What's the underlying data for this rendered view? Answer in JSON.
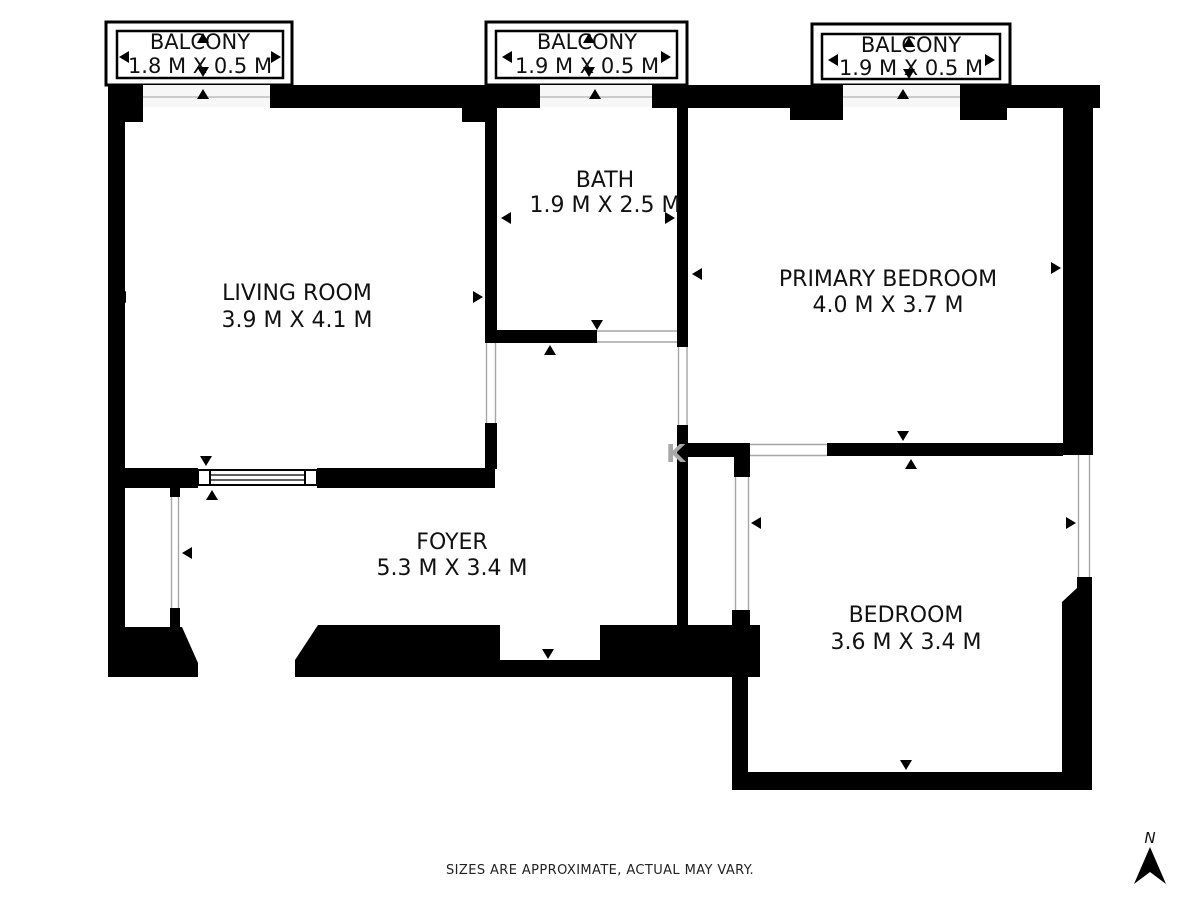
{
  "plan": {
    "balconies": [
      {
        "name": "BALCONY",
        "dims": "1.8 M X 0.5 M"
      },
      {
        "name": "BALCONY",
        "dims": "1.9 M X 0.5 M"
      },
      {
        "name": "BALCONY",
        "dims": "1.9 M X 0.5 M"
      }
    ],
    "rooms": [
      {
        "name": "LIVING ROOM",
        "dims": "3.9 M X 4.1 M"
      },
      {
        "name": "BATH",
        "dims": "1.9 M X 2.5 M"
      },
      {
        "name": "PRIMARY BEDROOM",
        "dims": "4.0 M X 3.7 M"
      },
      {
        "name": "FOYER",
        "dims": "5.3 M X 3.4 M"
      },
      {
        "name": "BEDROOM",
        "dims": "3.6 M X 3.4 M"
      }
    ],
    "disclaimer": "SIZES ARE APPROXIMATE, ACTUAL MAY VARY.",
    "compass": {
      "label": "N"
    },
    "watermark": "K",
    "colors": {
      "wall": "#000000",
      "background": "#ffffff",
      "opening_line": "#a6a6a6",
      "text": "#111111",
      "watermark": "#a8a8a8"
    }
  }
}
